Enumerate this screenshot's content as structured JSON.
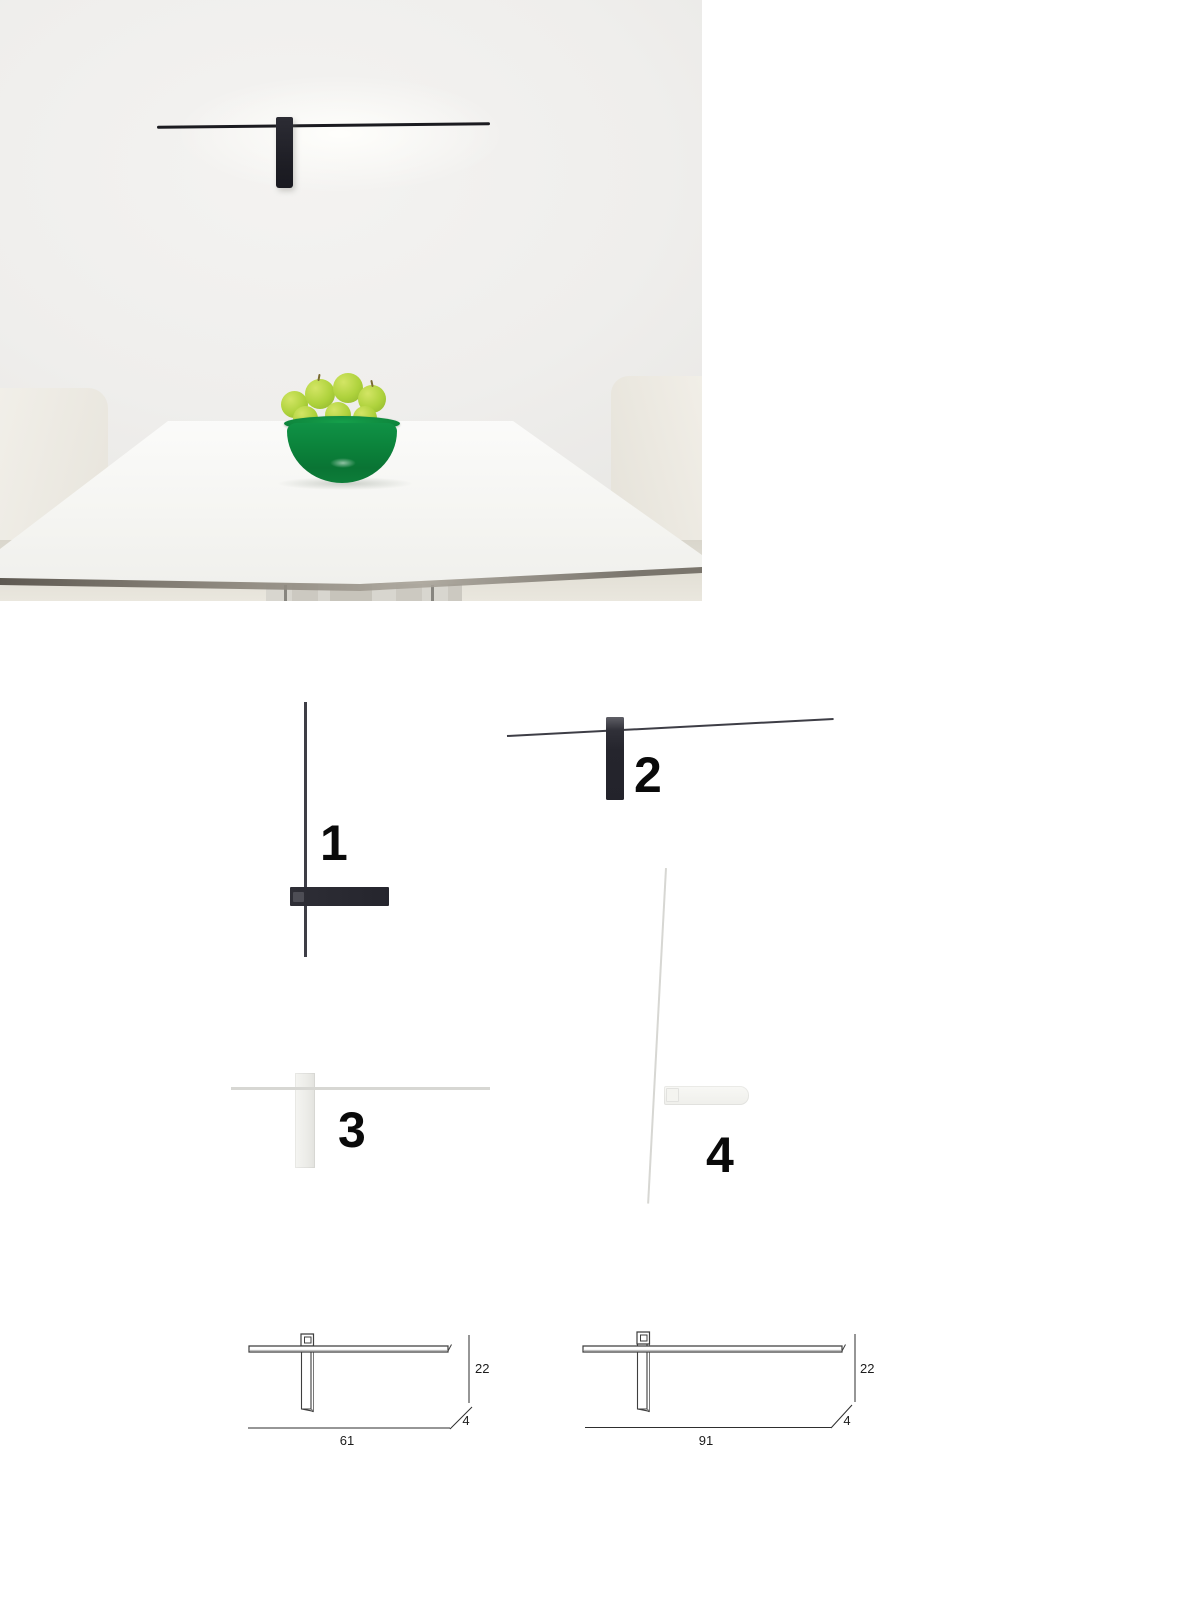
{
  "photo": {
    "wall_color": "#efeeec",
    "lamp_color": "#1f1f26",
    "table_color": "#f6f6f3",
    "chair_color": "#eeebe3",
    "bowl_color": "#0d8c3f",
    "apple_color": "#aed23c"
  },
  "variants": [
    {
      "label": "1",
      "finish": "#2a2a32"
    },
    {
      "label": "2",
      "finish": "#2a2a32"
    },
    {
      "label": "3",
      "finish": "#f2f2ef"
    },
    {
      "label": "4",
      "finish": "#f2f2ef"
    }
  ],
  "dimensions": [
    {
      "width": "61",
      "height": "22",
      "depth": "4"
    },
    {
      "width": "91",
      "height": "22",
      "depth": "4"
    }
  ]
}
